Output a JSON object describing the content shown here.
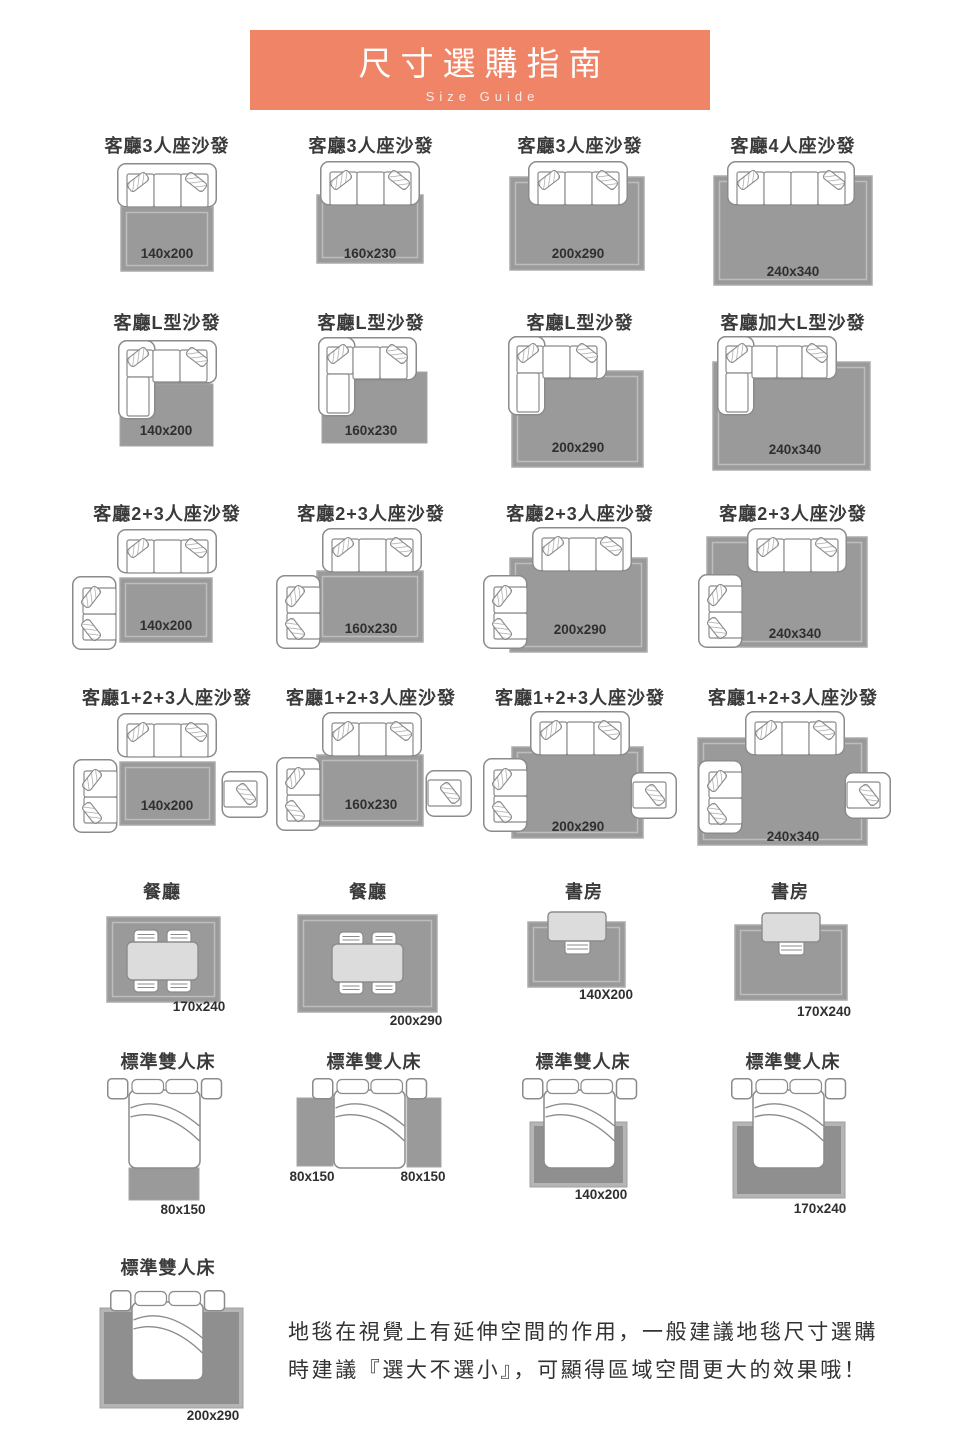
{
  "header": {
    "title": "尺寸選購指南",
    "subtitle": "Size Guide"
  },
  "colors": {
    "banner": "#EF8467",
    "rug": "#9A9A9A",
    "rug_dark": "#8F8F8F",
    "label_text": "#2F2F2F"
  },
  "rows": [
    {
      "items": [
        {
          "title": "客廳3人座沙發",
          "size": "140x200"
        },
        {
          "title": "客廳3人座沙發",
          "size": "160x230"
        },
        {
          "title": "客廳3人座沙發",
          "size": "200x290"
        },
        {
          "title": "客廳4人座沙發",
          "size": "240x340"
        }
      ]
    },
    {
      "items": [
        {
          "title": "客廳L型沙發",
          "size": "140x200"
        },
        {
          "title": "客廳L型沙發",
          "size": "160x230"
        },
        {
          "title": "客廳L型沙發",
          "size": "200x290"
        },
        {
          "title": "客廳加大L型沙發",
          "size": "240x340"
        }
      ]
    },
    {
      "items": [
        {
          "title": "客廳2+3人座沙發",
          "size": "140x200"
        },
        {
          "title": "客廳2+3人座沙發",
          "size": "160x230"
        },
        {
          "title": "客廳2+3人座沙發",
          "size": "200x290"
        },
        {
          "title": "客廳2+3人座沙發",
          "size": "240x340"
        }
      ]
    },
    {
      "items": [
        {
          "title": "客廳1+2+3人座沙發",
          "size": "140x200"
        },
        {
          "title": "客廳1+2+3人座沙發",
          "size": "160x230"
        },
        {
          "title": "客廳1+2+3人座沙發",
          "size": "200x290"
        },
        {
          "title": "客廳1+2+3人座沙發",
          "size": "240x340"
        }
      ]
    },
    {
      "items": [
        {
          "title": "餐廳",
          "size": "170x240"
        },
        {
          "title": "餐廳",
          "size": "200x290"
        },
        {
          "title": "書房",
          "size": "140X200"
        },
        {
          "title": "書房",
          "size": "170X240"
        }
      ]
    },
    {
      "items": [
        {
          "title": "標準雙人床",
          "size": "80x150"
        },
        {
          "title": "標準雙人床",
          "size_left": "80x150",
          "size_right": "80x150"
        },
        {
          "title": "標準雙人床",
          "size": "140x200"
        },
        {
          "title": "標準雙人床",
          "size": "170x240"
        }
      ]
    },
    {
      "items": [
        {
          "title": "標準雙人床",
          "size": "200x290"
        }
      ]
    }
  ],
  "footer": {
    "line1": "地毯在視覺上有延伸空間的作用，一般建議地毯尺寸選購",
    "line2": "時建議『選大不選小』，可顯得區域空間更大的效果哦！"
  }
}
